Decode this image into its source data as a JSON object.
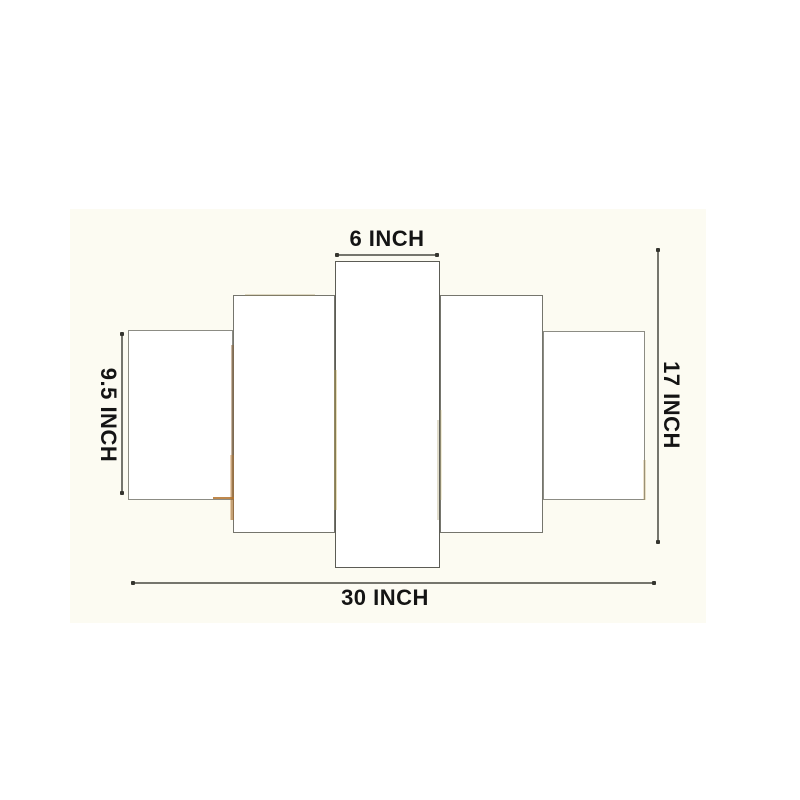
{
  "title": "5 panel wall art size diagram",
  "colors": {
    "page_bg": "#ffffff",
    "photo_bg": "#fcfbf2",
    "panel_fill": "#ffffff",
    "panel_border_outer": "#8c8c84",
    "panel_border_mid": "#75756d",
    "panel_border_center": "#5c5c55",
    "dim_line": "#75756d",
    "dim_end_dot": "#35352f",
    "label_text": "#141414"
  },
  "dimensions": {
    "top": {
      "label": "6 INCH"
    },
    "left": {
      "label": "9.5 INCH"
    },
    "right": {
      "label": "17 INCH"
    },
    "bottom": {
      "label": "30 INCH"
    }
  },
  "panels": [
    {
      "name": "art-panel-1-far-left",
      "x": 128,
      "y": 330,
      "w": 105,
      "h": 170,
      "border": "outer"
    },
    {
      "name": "art-panel-5-far-right",
      "x": 543,
      "y": 331,
      "w": 102,
      "h": 169,
      "border": "outer"
    },
    {
      "name": "art-panel-2-left",
      "x": 233,
      "y": 295,
      "w": 102,
      "h": 238,
      "border": "mid"
    },
    {
      "name": "art-panel-4-right",
      "x": 440,
      "y": 295,
      "w": 103,
      "h": 238,
      "border": "mid"
    },
    {
      "name": "art-panel-3-center",
      "x": 335,
      "y": 261,
      "w": 105,
      "h": 307,
      "border": "center"
    }
  ],
  "artifacts": [
    {
      "name": "p2-left-edge-tint",
      "x": 231,
      "y": 345,
      "w": 3,
      "h": 175,
      "color": "#8a5f33",
      "opacity": 0.45
    },
    {
      "name": "p2-left-lower-glow",
      "x": 230,
      "y": 455,
      "w": 4,
      "h": 65,
      "color": "#c07a2e",
      "opacity": 0.35
    },
    {
      "name": "p1-bottom-orange",
      "x": 213,
      "y": 497,
      "w": 21,
      "h": 2,
      "color": "#b4732d",
      "opacity": 0.85
    },
    {
      "name": "p3-left-edge-tint",
      "x": 334,
      "y": 370,
      "w": 3,
      "h": 140,
      "color": "#c3a952",
      "opacity": 0.4
    },
    {
      "name": "p3-right-edge-tint",
      "x": 437,
      "y": 420,
      "w": 2,
      "h": 100,
      "color": "#9a8d55",
      "opacity": 0.3
    },
    {
      "name": "p2-top-edge-tint",
      "x": 245,
      "y": 294,
      "w": 70,
      "h": 2,
      "color": "#9a8a55",
      "opacity": 0.3
    },
    {
      "name": "p4-left-edge-tint",
      "x": 440,
      "y": 410,
      "w": 2,
      "h": 90,
      "color": "#cdbd7a",
      "opacity": 0.3
    },
    {
      "name": "p5-right-bottom-tint",
      "x": 643,
      "y": 460,
      "w": 3,
      "h": 40,
      "color": "#b99a55",
      "opacity": 0.3
    }
  ]
}
